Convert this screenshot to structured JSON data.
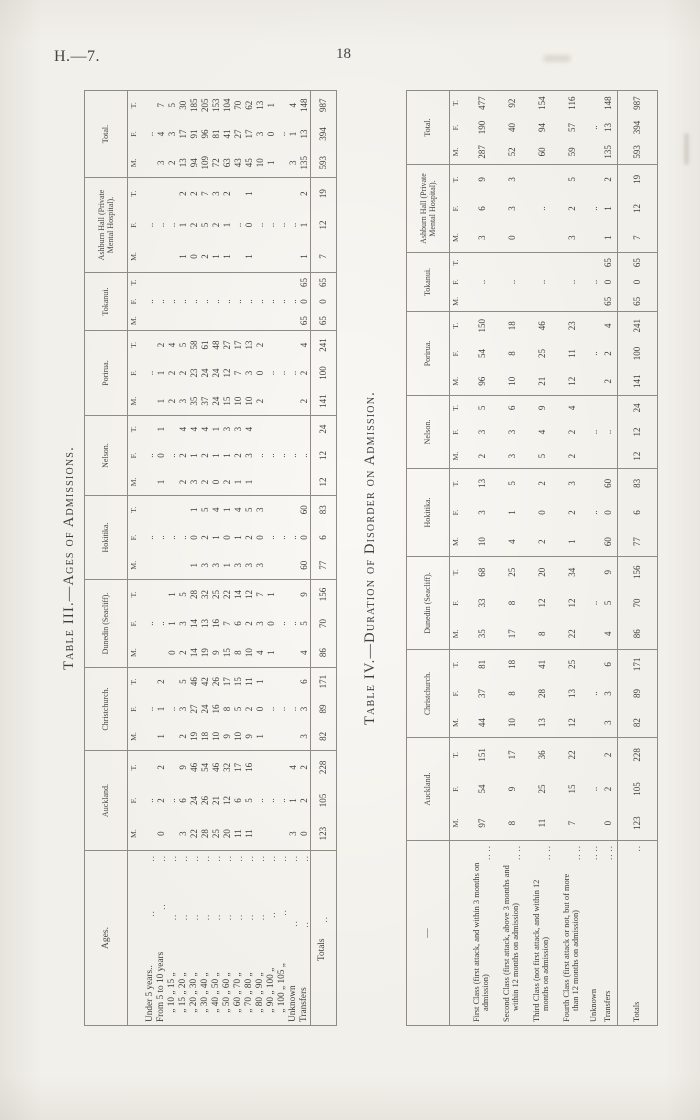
{
  "page": {
    "header_left": "H.—7.",
    "page_number": "18"
  },
  "subcols": [
    "M.",
    "F.",
    "T."
  ],
  "table3": {
    "title": "Table III.—Ages of Admissions.",
    "stub_header": "Ages.",
    "columns": [
      "Auckland.",
      "Christchurch.",
      "Dunedin (Seacliff).",
      "Hokitika.",
      "Nelson.",
      "Porirua.",
      "Tokanui.",
      "Ashburn Hall (Private Mental Hospital).",
      "Total."
    ],
    "rows": [
      {
        "label": "Under 5 years..",
        "cells": [
          [
            "",
            "..",
            ""
          ],
          [
            "",
            "..",
            ""
          ],
          [
            "",
            "..",
            ""
          ],
          [
            "",
            "..",
            ""
          ],
          [
            "",
            "..",
            ""
          ],
          [
            "",
            "..",
            ""
          ],
          [
            "",
            "..",
            ""
          ],
          [
            "",
            "..",
            ""
          ],
          [
            "",
            "..",
            ""
          ]
        ]
      },
      {
        "label": "From 5 to 10 years",
        "cells": [
          [
            "0",
            "2",
            "2"
          ],
          [
            "1",
            "1",
            "2"
          ],
          [
            "",
            "..",
            ""
          ],
          [
            "",
            "..",
            ""
          ],
          [
            "1",
            "0",
            "1"
          ],
          [
            "1",
            "1",
            "2"
          ],
          [
            "",
            "..",
            ""
          ],
          [
            "",
            "..",
            ""
          ],
          [
            "3",
            "4",
            "7"
          ]
        ]
      },
      {
        "label": " „ 10 „ 15 „",
        "cells": [
          [
            "",
            "..",
            ""
          ],
          [
            "",
            "..",
            ""
          ],
          [
            "0",
            "1",
            "1"
          ],
          [
            "",
            "..",
            ""
          ],
          [
            "",
            "..",
            ""
          ],
          [
            "2",
            "2",
            "4"
          ],
          [
            "",
            "..",
            ""
          ],
          [
            "",
            "..",
            ""
          ],
          [
            "2",
            "3",
            "5"
          ]
        ]
      },
      {
        "label": " „ 15 „ 20 „",
        "cells": [
          [
            "3",
            "6",
            "9"
          ],
          [
            "2",
            "3",
            "5"
          ],
          [
            "2",
            "3",
            "5"
          ],
          [
            "",
            "..",
            ""
          ],
          [
            "2",
            "2",
            "4"
          ],
          [
            "3",
            "2",
            "5"
          ],
          [
            "",
            "..",
            ""
          ],
          [
            "1",
            "1",
            "2"
          ],
          [
            "13",
            "17",
            "30"
          ]
        ]
      },
      {
        "label": " „ 20 „ 30 „",
        "cells": [
          [
            "22",
            "24",
            "46"
          ],
          [
            "19",
            "27",
            "46"
          ],
          [
            "14",
            "14",
            "28"
          ],
          [
            "1",
            "0",
            "1"
          ],
          [
            "3",
            "1",
            "4"
          ],
          [
            "35",
            "23",
            "58"
          ],
          [
            "",
            "..",
            ""
          ],
          [
            "0",
            "2",
            "2"
          ],
          [
            "94",
            "91",
            "185"
          ]
        ]
      },
      {
        "label": " „ 30 „ 40 „",
        "cells": [
          [
            "28",
            "26",
            "54"
          ],
          [
            "18",
            "24",
            "42"
          ],
          [
            "19",
            "13",
            "32"
          ],
          [
            "3",
            "2",
            "5"
          ],
          [
            "2",
            "2",
            "4"
          ],
          [
            "37",
            "24",
            "61"
          ],
          [
            "",
            "..",
            ""
          ],
          [
            "2",
            "5",
            "7"
          ],
          [
            "109",
            "96",
            "205"
          ]
        ]
      },
      {
        "label": " „ 40 „ 50 „",
        "cells": [
          [
            "25",
            "21",
            "46"
          ],
          [
            "10",
            "16",
            "26"
          ],
          [
            "9",
            "16",
            "25"
          ],
          [
            "3",
            "1",
            "4"
          ],
          [
            "0",
            "1",
            "1"
          ],
          [
            "24",
            "24",
            "48"
          ],
          [
            "",
            "..",
            ""
          ],
          [
            "1",
            "2",
            "3"
          ],
          [
            "72",
            "81",
            "153"
          ]
        ]
      },
      {
        "label": " „ 50 „ 60 „",
        "cells": [
          [
            "20",
            "12",
            "32"
          ],
          [
            "9",
            "8",
            "17"
          ],
          [
            "15",
            "7",
            "22"
          ],
          [
            "1",
            "0",
            "1"
          ],
          [
            "2",
            "1",
            "3"
          ],
          [
            "15",
            "12",
            "27"
          ],
          [
            "",
            "..",
            ""
          ],
          [
            "1",
            "1",
            "2"
          ],
          [
            "63",
            "41",
            "104"
          ]
        ]
      },
      {
        "label": " „ 60 „ 70 „",
        "cells": [
          [
            "11",
            "6",
            "17"
          ],
          [
            "10",
            "5",
            "15"
          ],
          [
            "8",
            "6",
            "14"
          ],
          [
            "3",
            "1",
            "4"
          ],
          [
            "1",
            "2",
            "3"
          ],
          [
            "10",
            "7",
            "17"
          ],
          [
            "",
            "..",
            ""
          ],
          [
            "",
            "..",
            ""
          ],
          [
            "43",
            "27",
            "70"
          ]
        ]
      },
      {
        "label": " „ 70 „ 80 „",
        "cells": [
          [
            "11",
            "5",
            "16"
          ],
          [
            "9",
            "2",
            "11"
          ],
          [
            "10",
            "2",
            "12"
          ],
          [
            "3",
            "2",
            "5"
          ],
          [
            "1",
            "3",
            "4"
          ],
          [
            "10",
            "3",
            "13"
          ],
          [
            "",
            "..",
            ""
          ],
          [
            "1",
            "0",
            "1"
          ],
          [
            "45",
            "17",
            "62"
          ]
        ]
      },
      {
        "label": " „ 80 „ 90 „",
        "cells": [
          [
            "",
            "..",
            ""
          ],
          [
            "1",
            "0",
            "1"
          ],
          [
            "4",
            "3",
            "7"
          ],
          [
            "3",
            "0",
            "3"
          ],
          [
            "",
            "..",
            ""
          ],
          [
            "2",
            "0",
            "2"
          ],
          [
            "",
            "..",
            ""
          ],
          [
            "",
            "..",
            ""
          ],
          [
            "10",
            "3",
            "13"
          ]
        ]
      },
      {
        "label": " „ 90 „ 100 „",
        "cells": [
          [
            "",
            "..",
            ""
          ],
          [
            "",
            "..",
            ""
          ],
          [
            "1",
            "0",
            "1"
          ],
          [
            "",
            "..",
            ""
          ],
          [
            "",
            "..",
            ""
          ],
          [
            "",
            "..",
            ""
          ],
          [
            "",
            "..",
            ""
          ],
          [
            "",
            "..",
            ""
          ],
          [
            "1",
            "0",
            "1"
          ]
        ]
      },
      {
        "label": " „ 100 „ 105 „",
        "cells": [
          [
            "",
            "..",
            ""
          ],
          [
            "",
            "..",
            ""
          ],
          [
            "",
            "..",
            ""
          ],
          [
            "",
            "..",
            ""
          ],
          [
            "",
            "..",
            ""
          ],
          [
            "",
            "..",
            ""
          ],
          [
            "",
            "..",
            ""
          ],
          [
            "",
            "..",
            ""
          ],
          [
            "",
            "..",
            ""
          ]
        ]
      },
      {
        "label": "Unknown",
        "cells": [
          [
            "3",
            "1",
            "4"
          ],
          [
            "",
            "..",
            ""
          ],
          [
            "",
            "..",
            ""
          ],
          [
            "",
            "..",
            ""
          ],
          [
            "",
            "..",
            ""
          ],
          [
            "",
            "..",
            ""
          ],
          [
            "",
            "..",
            ""
          ],
          [
            "",
            "..",
            ""
          ],
          [
            "3",
            "1",
            "4"
          ]
        ]
      },
      {
        "label": "Transfers",
        "cells": [
          [
            "0",
            "2",
            "2"
          ],
          [
            "3",
            "3",
            "6"
          ],
          [
            "4",
            "5",
            "9"
          ],
          [
            "60",
            "0",
            "60"
          ],
          [
            "",
            "..",
            ""
          ],
          [
            "2",
            "2",
            "4"
          ],
          [
            "65",
            "0",
            "65"
          ],
          [
            "1",
            "1",
            "2"
          ],
          [
            "135",
            "13",
            "148"
          ]
        ]
      },
      {
        "label": "Totals",
        "cells": [
          [
            "123",
            "105",
            "228"
          ],
          [
            "82",
            "89",
            "171"
          ],
          [
            "86",
            "70",
            "156"
          ],
          [
            "77",
            "6",
            "83"
          ],
          [
            "12",
            "12",
            "24"
          ],
          [
            "141",
            "100",
            "241"
          ],
          [
            "65",
            "0",
            "65"
          ],
          [
            "7",
            "12",
            "19"
          ],
          [
            "593",
            "394",
            "987"
          ]
        ]
      }
    ]
  },
  "table4": {
    "title": "Table IV.—Duration of Disorder on Admission.",
    "stub_header": "—",
    "columns": [
      "Auckland.",
      "Christchurch.",
      "Dunedin (Seacliff).",
      "Hokitika.",
      "Nelson.",
      "Porirua.",
      "Tokanui.",
      "Ashburn Hall (Private Mental Hospital).",
      "Total."
    ],
    "rows": [
      {
        "label": "First Class (first attack, and within 3 months on admission)",
        "cells": [
          [
            "97",
            "54",
            "151"
          ],
          [
            "44",
            "37",
            "81"
          ],
          [
            "35",
            "33",
            "68"
          ],
          [
            "10",
            "3",
            "13"
          ],
          [
            "2",
            "3",
            "5"
          ],
          [
            "96",
            "54",
            "150"
          ],
          [
            "",
            "..",
            ""
          ],
          [
            "3",
            "6",
            "9"
          ],
          [
            "287",
            "190",
            "477"
          ]
        ]
      },
      {
        "label": "Second Class (first attack, above 3 months and within 12 months on admission)",
        "cells": [
          [
            "8",
            "9",
            "17"
          ],
          [
            "10",
            "8",
            "18"
          ],
          [
            "17",
            "8",
            "25"
          ],
          [
            "4",
            "1",
            "5"
          ],
          [
            "3",
            "3",
            "6"
          ],
          [
            "10",
            "8",
            "18"
          ],
          [
            "",
            "..",
            ""
          ],
          [
            "0",
            "3",
            "3"
          ],
          [
            "52",
            "40",
            "92"
          ]
        ]
      },
      {
        "label": "Third Class (not first attack, and within 12 months on admission)",
        "cells": [
          [
            "11",
            "25",
            "36"
          ],
          [
            "13",
            "28",
            "41"
          ],
          [
            "8",
            "12",
            "20"
          ],
          [
            "2",
            "0",
            "2"
          ],
          [
            "5",
            "4",
            "9"
          ],
          [
            "21",
            "25",
            "46"
          ],
          [
            "",
            "..",
            ""
          ],
          [
            "",
            "..",
            ""
          ],
          [
            "60",
            "94",
            "154"
          ]
        ]
      },
      {
        "label": "Fourth Class (first attack or not, but of more than 12 months on admission)",
        "cells": [
          [
            "7",
            "15",
            "22"
          ],
          [
            "12",
            "13",
            "25"
          ],
          [
            "22",
            "12",
            "34"
          ],
          [
            "1",
            "2",
            "3"
          ],
          [
            "2",
            "2",
            "4"
          ],
          [
            "12",
            "11",
            "23"
          ],
          [
            "",
            "..",
            ""
          ],
          [
            "3",
            "2",
            "5"
          ],
          [
            "59",
            "57",
            "116"
          ]
        ]
      },
      {
        "label": "Unknown",
        "cells": [
          [
            "",
            "..",
            ""
          ],
          [
            "",
            "..",
            ""
          ],
          [
            "",
            "..",
            ""
          ],
          [
            "",
            "..",
            ""
          ],
          [
            "",
            "..",
            ""
          ],
          [
            "",
            "..",
            ""
          ],
          [
            "",
            "..",
            ""
          ],
          [
            "",
            "..",
            ""
          ],
          [
            "",
            "..",
            ""
          ]
        ]
      },
      {
        "label": "Transfers",
        "cells": [
          [
            "0",
            "2",
            "2"
          ],
          [
            "3",
            "3",
            "6"
          ],
          [
            "4",
            "5",
            "9"
          ],
          [
            "60",
            "0",
            "60"
          ],
          [
            "",
            "..",
            ""
          ],
          [
            "2",
            "2",
            "4"
          ],
          [
            "65",
            "0",
            "65"
          ],
          [
            "1",
            "1",
            "2"
          ],
          [
            "135",
            "13",
            "148"
          ]
        ]
      },
      {
        "label": "Totals",
        "cells": [
          [
            "123",
            "105",
            "228"
          ],
          [
            "82",
            "89",
            "171"
          ],
          [
            "86",
            "70",
            "156"
          ],
          [
            "77",
            "6",
            "83"
          ],
          [
            "12",
            "12",
            "24"
          ],
          [
            "141",
            "100",
            "241"
          ],
          [
            "65",
            "0",
            "65"
          ],
          [
            "7",
            "12",
            "19"
          ],
          [
            "593",
            "394",
            "987"
          ]
        ]
      }
    ]
  }
}
